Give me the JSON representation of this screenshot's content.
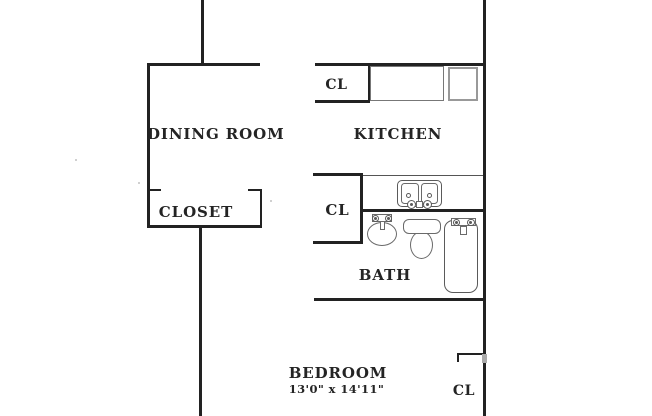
{
  "plan": {
    "type": "apartment-floor-plan",
    "rooms": {
      "dining": {
        "label": "DINING ROOM"
      },
      "dining_closet": {
        "label": "CLOSET"
      },
      "kitchen": {
        "label": "KITCHEN",
        "closet_label": "CL"
      },
      "bath": {
        "label": "BATH",
        "closet_label": "CL"
      },
      "bedroom": {
        "label": "BEDROOM",
        "dimensions": "13'0\" x 14'11\"",
        "closet_label": "CL"
      }
    },
    "fixtures": [
      "kitchen-counter",
      "appliance",
      "kitchen-double-sink",
      "lavatory-sink",
      "toilet",
      "bathtub"
    ],
    "colors": {
      "wall": "#222222",
      "fixture": "#5a5a5a",
      "appliance_border": "#999999",
      "text": "#242424",
      "bg": "#ffffff"
    }
  }
}
